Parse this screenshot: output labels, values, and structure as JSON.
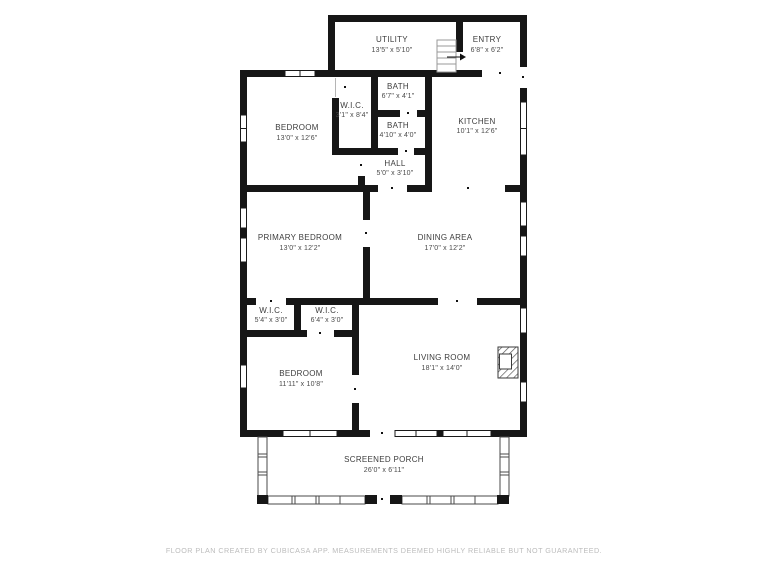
{
  "rooms": {
    "utility": {
      "name": "UTILITY",
      "dims": "13'5\" x 5'10\""
    },
    "entry": {
      "name": "ENTRY",
      "dims": "6'8\" x 6'2\""
    },
    "bath1": {
      "name": "BATH",
      "dims": "6'7\" x 4'1\""
    },
    "wic1": {
      "name": "W.I.C.",
      "dims": "3'1\" x 8'4\""
    },
    "bedroom1": {
      "name": "BEDROOM",
      "dims": "13'0\" x 12'6\""
    },
    "bath2": {
      "name": "BATH",
      "dims": "4'10\" x 4'0\""
    },
    "kitchen": {
      "name": "KITCHEN",
      "dims": "10'1\" x 12'6\""
    },
    "hall": {
      "name": "HALL",
      "dims": "5'0\" x 3'10\""
    },
    "primary": {
      "name": "PRIMARY BEDROOM",
      "dims": "13'0\" x 12'2\""
    },
    "dining": {
      "name": "DINING AREA",
      "dims": "17'0\" x 12'2\""
    },
    "wic2": {
      "name": "W.I.C.",
      "dims": "5'4\" x 3'0\""
    },
    "wic3": {
      "name": "W.I.C.",
      "dims": "6'4\" x 3'0\""
    },
    "bedroom2": {
      "name": "BEDROOM",
      "dims": "11'11\" x 10'8\""
    },
    "living": {
      "name": "LIVING ROOM",
      "dims": "18'1\" x 14'0\""
    },
    "porch": {
      "name": "SCREENED PORCH",
      "dims": "26'0\" x 6'11\""
    }
  },
  "footer": "FLOOR PLAN CREATED BY CUBICASA APP. MEASUREMENTS DEEMED HIGHLY RELIABLE BUT NOT GUARANTEED.",
  "colors": {
    "wall": "#161616",
    "label": "#3d3d3d",
    "footer_text": "#bcbcbc",
    "background": "#ffffff",
    "screen_outline": "#4a4a4a"
  }
}
